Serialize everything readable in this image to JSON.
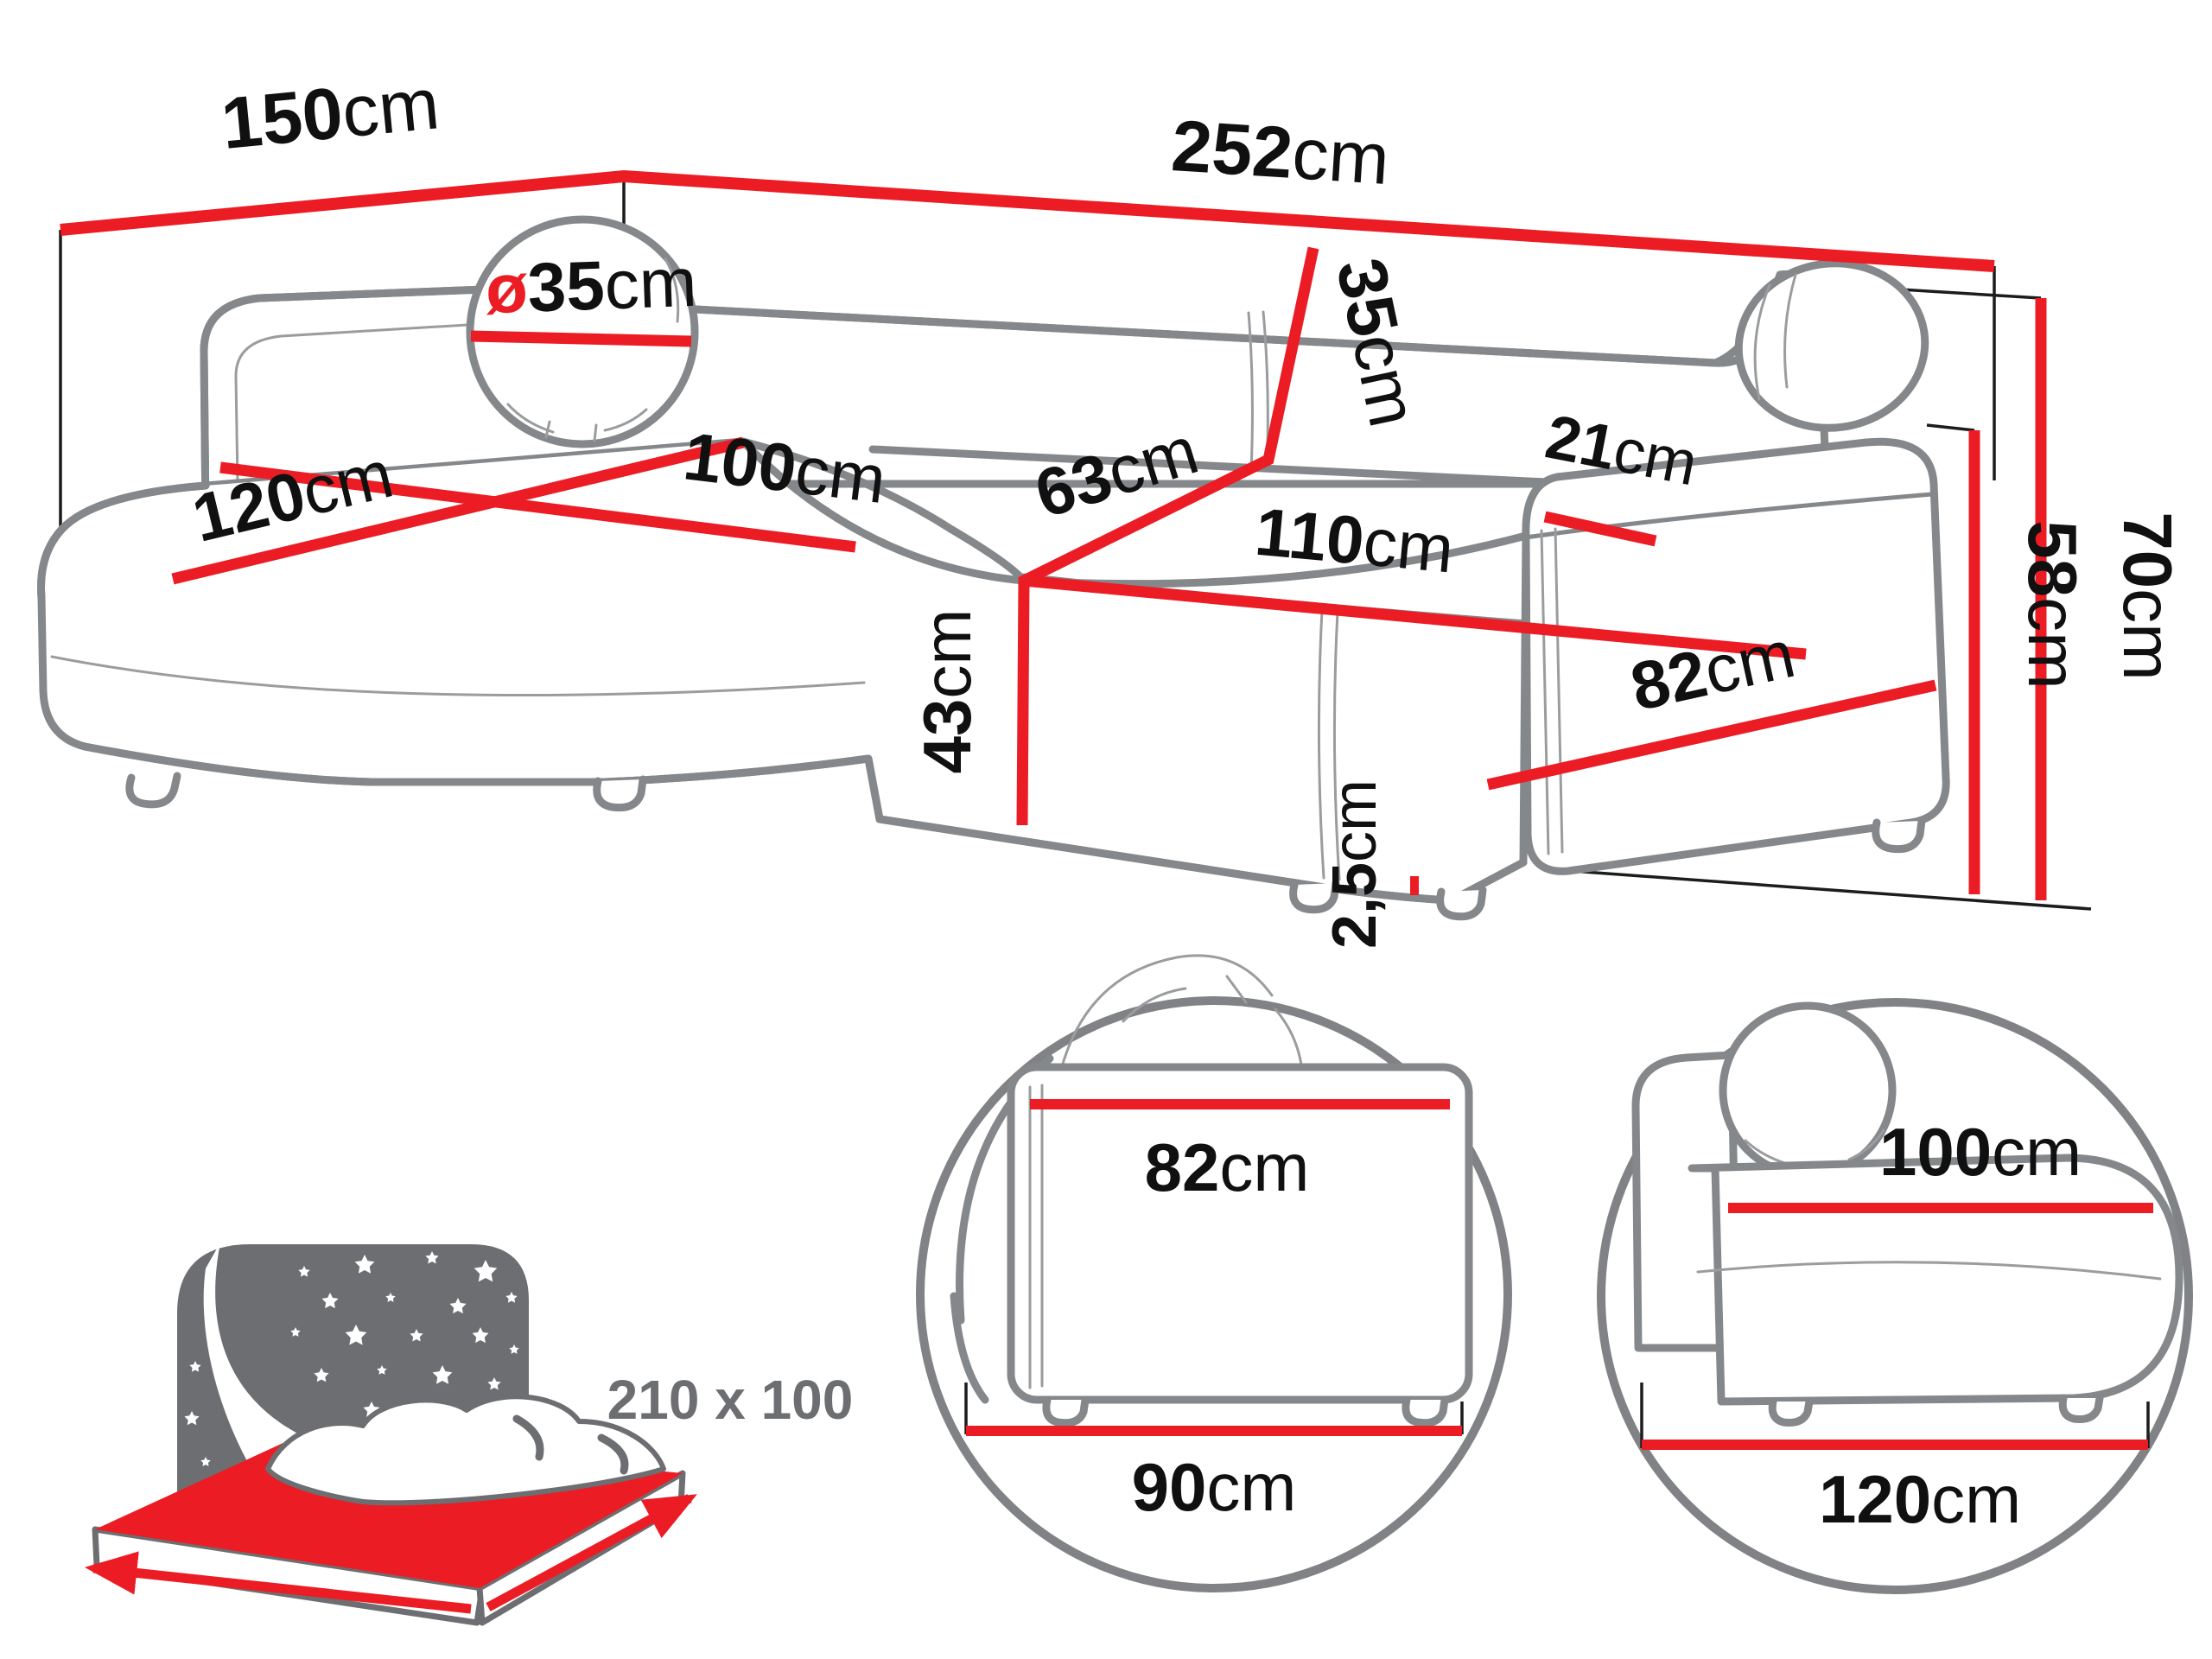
{
  "title": "Corner sofa dimensions diagram",
  "colors": {
    "dimension_red": "#ec1c24",
    "outline_gray": "#85888b",
    "icon_gray": "#6d6e71",
    "text_black": "#101010",
    "background": "#ffffff"
  },
  "dimensions": {
    "total_depth": {
      "value": "150",
      "unit": "cm"
    },
    "total_width": {
      "value": "252",
      "unit": "cm"
    },
    "pillow_diameter": {
      "prefix": "ø",
      "value": "35",
      "unit": "cm"
    },
    "backrest_height": {
      "value": "35",
      "unit": "cm"
    },
    "armrest_top_width": {
      "value": "21",
      "unit": "cm"
    },
    "chaise_width": {
      "value": "120",
      "unit": "cm"
    },
    "chaise_depth": {
      "value": "100",
      "unit": "cm"
    },
    "corner_seat_depth": {
      "value": "63",
      "unit": "cm"
    },
    "seat_front_width": {
      "value": "110",
      "unit": "cm"
    },
    "seat_height": {
      "value": "43",
      "unit": "cm"
    },
    "armrest_height": {
      "value": "58",
      "unit": "cm"
    },
    "total_height": {
      "value": "70",
      "unit": "cm"
    },
    "leg_height": {
      "value": "2,5",
      "unit": "cm"
    },
    "armrest_depth": {
      "value": "82",
      "unit": "cm"
    }
  },
  "sleeping_area": {
    "label": "210 x 100"
  },
  "detail_armrest": {
    "top_width": {
      "value": "82",
      "unit": "cm"
    },
    "bottom_width": {
      "value": "90",
      "unit": "cm"
    }
  },
  "detail_chaise": {
    "top_width": {
      "value": "100",
      "unit": "cm"
    },
    "bottom_width": {
      "value": "120",
      "unit": "cm"
    }
  }
}
